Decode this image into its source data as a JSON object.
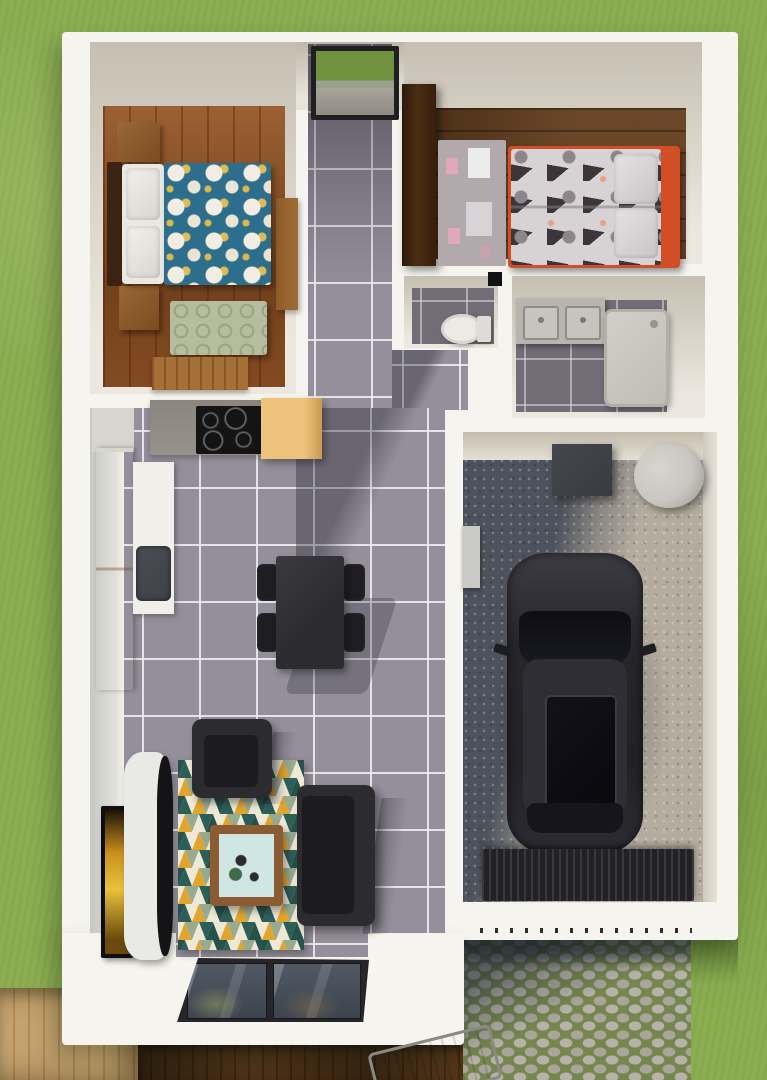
{
  "scene": {
    "type": "3d-floorplan-top-view",
    "description": "Top-down 3D architectural rendering of a small single-storey house: two bedrooms along the top, central entry hall, WC and bathroom in the middle, open-plan kitchen/dining/living area on the left, single garage with parked car on the right, cobblestone driveway, wooden decks and lawn around the house. No text is visible in the image."
  },
  "rooms": [
    {
      "id": "master-bedroom",
      "label": "Master bedroom"
    },
    {
      "id": "kids-bedroom",
      "label": "Kids bedroom"
    },
    {
      "id": "entry-hall",
      "label": "Entry hall"
    },
    {
      "id": "wc",
      "label": "WC"
    },
    {
      "id": "bathroom",
      "label": "Bathroom"
    },
    {
      "id": "kitchen",
      "label": "Kitchen"
    },
    {
      "id": "dining-area",
      "label": "Dining area"
    },
    {
      "id": "living-room",
      "label": "Living room"
    },
    {
      "id": "garage",
      "label": "Garage"
    },
    {
      "id": "driveway",
      "label": "Cobblestone driveway"
    },
    {
      "id": "deck",
      "label": "Wooden deck"
    },
    {
      "id": "garden",
      "label": "Lawn"
    }
  ],
  "objects": [
    "double-bed-teal-floral-duvet",
    "two-wooden-nightstands",
    "green-bench",
    "wooden-dresser",
    "front-door-with-glass",
    "two-roof-windows",
    "single-bed-orange-frame",
    "kids-play-rug",
    "dark-wardrobe",
    "toilet",
    "double-sink-vanity",
    "shower-tray",
    "induction-cooktop",
    "yellow-cabinets",
    "white-counter-with-sink",
    "dining-table-with-four-chairs",
    "tv",
    "curved-tv-console",
    "triangle-pattern-rug",
    "coffee-table",
    "armchair",
    "sofa",
    "sliding-glass-door",
    "black-car",
    "storage-box",
    "water-tank",
    "garage-door",
    "sun-lounger"
  ],
  "palette": {
    "grass": "#8cae52",
    "wall_white": "#f6f4ee",
    "wood_master": "#8a4e22",
    "wood_kids": "#5e3a1d",
    "tile": "#948f9a",
    "tile_dark": "#716c76",
    "teal_duvet": "#2e6e8d",
    "floral_cream": "#f1ede2",
    "floral_yellow": "#ddbb55",
    "bench_green": "#b6bd9e",
    "nightstand_wood": "#9a6836",
    "headboard_wood": "#3f2312",
    "bed_linen": "#eae8e3",
    "dresser_wood": "#a57038",
    "wardrobe_wood": "#4a2c12",
    "bed_orange": "#d14e27",
    "duvet_kids": "#d7d3d5",
    "rug_kids": "#b2a9ad",
    "rug_kids_pink": "#e0a8bc",
    "cab_yellow": "#eec47d",
    "counter_gray": "#979289",
    "counter_white": "#f0efe9",
    "sink_dark": "#3e4247",
    "cooktop_black": "#141414",
    "dining_black": "#2c2c30",
    "chair_black": "#1e1e22",
    "sofa_dark": "#2b2b30",
    "seat_dark": "#1c1c20",
    "rug_teal": "#2d5f58",
    "rug_green": "#98ab90",
    "rug_yellow": "#e2a52c",
    "rug_cream": "#eee8d7",
    "rug_dark": "#27514b",
    "coffee_wood": "#8b5c34",
    "coffee_glass": "#cfe6e4",
    "tv_black": "#0f0f12",
    "tv_screen": "#e8c23c",
    "console_white": "#e9e9e6",
    "concrete": "#b4ac9e",
    "concrete_shadow": "#4d525c",
    "car_body": "#26262b",
    "car_glass": "#1a1a22",
    "garage_door": "#212126",
    "tank_gray": "#c9c6c0",
    "box_dark": "#383b40",
    "toilet_white": "#eceae5",
    "vanity_gray": "#b7b5ae",
    "shower_gray": "#d2cfc7",
    "cobble_stone": "#b6b2a9",
    "cobble_grass": "#76864f",
    "deck_light": "#c4a26e",
    "deck_dark": "#4a2d12",
    "door_grass": "#70923f",
    "window_frame": "#2a2a2c",
    "window_glass": "#75757b"
  }
}
